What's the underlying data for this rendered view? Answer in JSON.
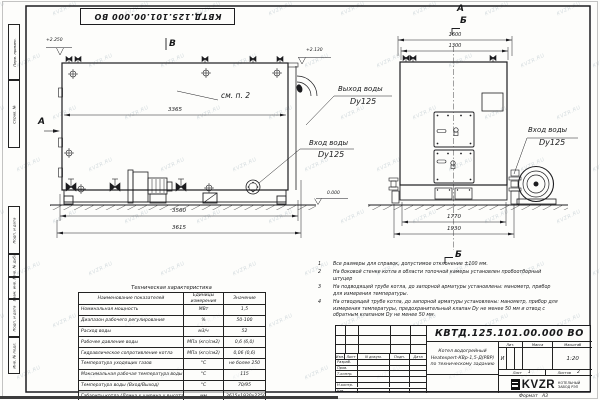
{
  "watermark_text": "KVZR.RU",
  "sheet": {
    "top_stamp": "КВТД.125.101.00.000  ВО",
    "margin_boxes": [
      {
        "label": "Перв. примен."
      },
      {
        "label": "Справ. №"
      },
      {
        "label": "Подп. и дата"
      },
      {
        "label": "Инв. № дубл."
      },
      {
        "label": "Взам. инв. №"
      },
      {
        "label": "Подп. и дата"
      },
      {
        "label": "Инв. № подл."
      }
    ],
    "format_label": "Формат",
    "format_value": "А3"
  },
  "side_view": {
    "section_b_top": "В",
    "section_a_left": "А",
    "elevation_top_left": "+2.250",
    "elevation_chimney": "+2.130",
    "elevation_zero": "0.000",
    "see_note": "см. п. 2",
    "dim_width_inner": "3365",
    "dim_width_base": "3560",
    "dim_width_overall": "3615",
    "outlet_line1": "Выход воды",
    "outlet_line2": "Dy125",
    "inlet_line1": "Вход воды",
    "inlet_line2": "Dy125"
  },
  "front_view": {
    "section_a": "А",
    "section_b": "Б",
    "section_b_bottom": "Б",
    "dim_top_outer": "1600",
    "dim_top_inner": "1300",
    "dim_bottom_inner": "1770",
    "dim_bottom_outer": "1930",
    "inlet_line1": "Вход воды",
    "inlet_line2": "Dy125"
  },
  "notes": {
    "items": [
      {
        "num": "1",
        "text": "Все размеры для справок, допустимое отклонение ±100 мм."
      },
      {
        "num": "2",
        "text": "На боковой стенке котла в области топочной камеры установлен пробоотборный штуцер"
      },
      {
        "num": "3",
        "text": "На  подводящей трубе котла, до запорной арматуры установлены: манометр, прибор для измерения температуры."
      },
      {
        "num": "4",
        "text": "На отводящей трубе котла, до запорной арматуры установлены: манометр, прибор для измерения температуры, предохранительный клапан Dу не менее 50 мм и отвод с обратным клапаном Dу не менее 50 мм."
      }
    ]
  },
  "tech_table": {
    "title": "Техническая характеристика",
    "headers": [
      "Наименование показателей",
      "Единицы измерения",
      "Значение"
    ],
    "rows": [
      [
        "Номинальная мощность",
        "МВт",
        "1,5"
      ],
      [
        "Диапазон рабочего регулирования",
        "%",
        "50-100"
      ],
      [
        "Расход воды",
        "м3/ч",
        "52"
      ],
      [
        "Рабочее давление воды",
        "МПа (кгс/см2)",
        "0,6 (6,0)"
      ],
      [
        "Гидравлическое сопротивление котла",
        "МПа (кгс/см2)",
        "0,06 (0,6)"
      ],
      [
        "Температура уходящих газов",
        "°С",
        "не более 250"
      ],
      [
        "Максимальная рабочая температура воды",
        "°С",
        "115"
      ],
      [
        "Температура воды (Вход/Выход)",
        "°С",
        "70/95"
      ],
      [
        "Габариты котла (Длина х ширина х высота)",
        "мм",
        "3615х1930х2250"
      ]
    ]
  },
  "title_block": {
    "designation": "КВТД.125.101.00.000  ВО",
    "description": [
      "Котел водогрейный",
      "Heatexpert-КВр-1,5-Д(РВР)",
      "по техническому заданию"
    ],
    "columns": [
      "Изм.",
      "Лист",
      "N докум.",
      "Подп.",
      "Дата"
    ],
    "rows": [
      "Разраб.",
      "Пров.",
      "Т.контр.",
      "Н.контр.",
      "Утв."
    ],
    "lit_label": "Лит.",
    "lit_value": "И",
    "mass_label": "Масса",
    "scale_label": "Масштаб",
    "scale_value": "1:20",
    "sheet_label": "Лист",
    "sheet_num": "1",
    "sheets_label": "Листов",
    "sheets_num": "2",
    "logo": "KVZR",
    "logo_caption1": "КОТЕЛЬНЫЙ",
    "logo_caption2": "ЗАВОД РЭП"
  }
}
